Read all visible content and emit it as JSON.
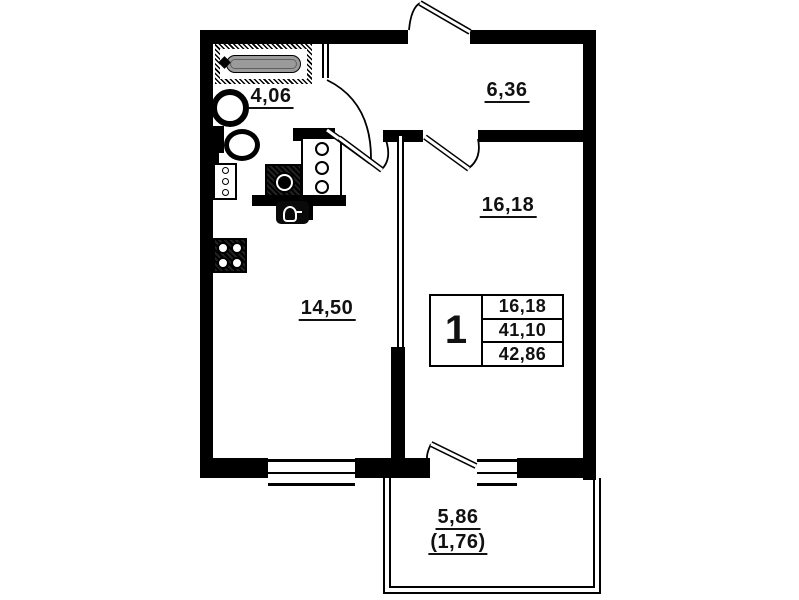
{
  "page": {
    "title": "One-room apartment floor plan"
  },
  "rooms": {
    "bathroom": {
      "area": "4,06"
    },
    "hallway": {
      "area": "6,36"
    },
    "bedroom": {
      "area": "16,18"
    },
    "living": {
      "area": "14,50"
    },
    "balcony": {
      "area": "5,86",
      "area_coefficient": "(1,76)"
    }
  },
  "stamp": {
    "rooms_count": "1",
    "living_area": "16,18",
    "apartment_area": "41,10",
    "total_area": "42,86"
  },
  "colors": {
    "wall": "#000000",
    "background": "#ffffff",
    "bathtub_fill": "#9b9b9b"
  },
  "icons": [
    "bathtub-icon",
    "washbasin-icon",
    "toilet-icon",
    "washing-machine-icon",
    "cabinet-icon",
    "fridge-icon",
    "kitchen-sink-icon",
    "stove-icon",
    "window",
    "door-swing"
  ]
}
